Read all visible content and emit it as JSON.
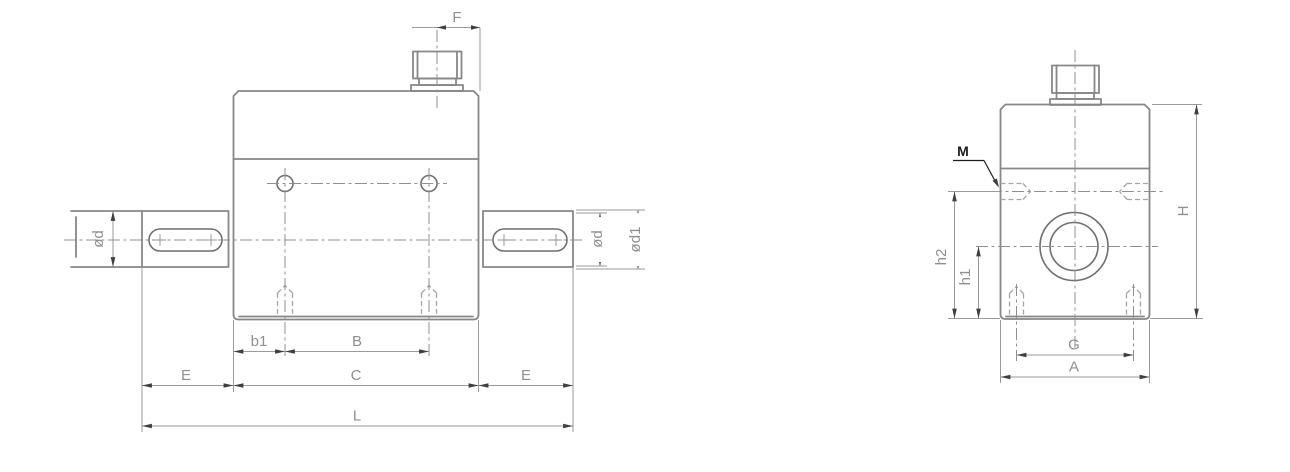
{
  "drawing": {
    "kind": "engineering-drawing-two-views",
    "front_view": {
      "labels": {
        "f": "F",
        "d_left": "ød",
        "d_right": "ød",
        "d1": "ød1",
        "b1": "b1",
        "b": "B",
        "c": "C",
        "e_left": "E",
        "e_right": "E",
        "l": "L"
      }
    },
    "side_view": {
      "labels": {
        "m": "M",
        "h2": "h2",
        "h1": "h1",
        "g": "G",
        "a": "A",
        "h": "H"
      }
    },
    "colors": {
      "background": "#ffffff",
      "object_line": "#878787",
      "detail_line": "#6e6e6e",
      "dimension_line": "#9a9a9a",
      "center_line": "#8f8f8f",
      "hidden_line": "#a5a5a5",
      "arrow": "#3f3f3f",
      "label_text": "#8f8f8f",
      "callout_text": "#1c1c1c"
    }
  }
}
